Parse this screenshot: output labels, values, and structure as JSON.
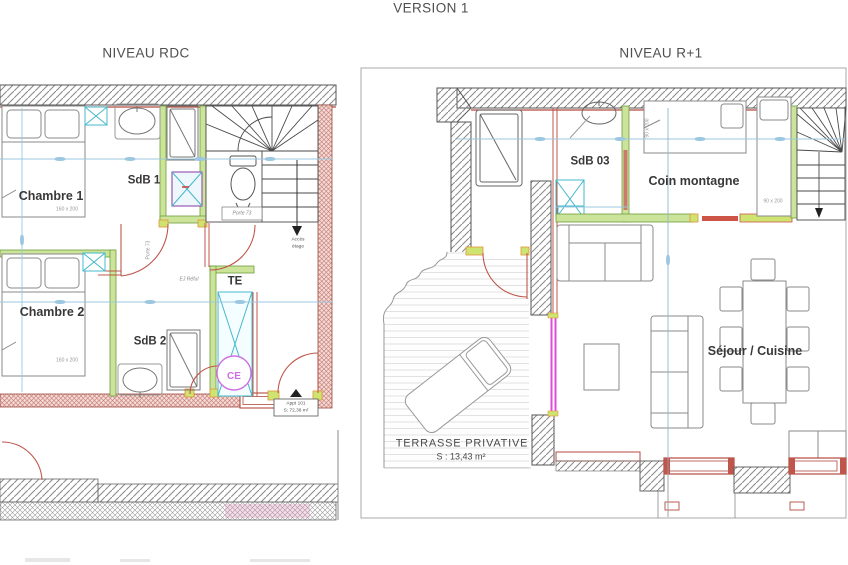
{
  "header": {
    "version_title": "VERSION 1"
  },
  "plan_rdc": {
    "title": "NIVEAU RDC",
    "labels": {
      "chambre1": "Chambre 1",
      "chambre1_bed_size": "160 x 200",
      "chambre2": "Chambre 2",
      "chambre2_bed_size": "160 x 200",
      "sdb1": "SdB 1",
      "sdb2": "SdB 2",
      "te": "TE",
      "ce": "CE",
      "porte_stairs": "Porte 73",
      "porte_chambre": "Porte 73",
      "ej_reful": "EJ Réful",
      "acces_line1": "Accès",
      "acces_line2": "étage",
      "appt_line1": "Appt 101",
      "appt_line2": "S: 72,36 m²"
    }
  },
  "plan_r1": {
    "title": "NIVEAU R+1",
    "labels": {
      "sdb03": "SdB 03",
      "coin_montagne": "Coin montagne",
      "bed_size_h": "90 x 200",
      "bed_size_v": "90 x 200",
      "sejour_cuisine": "Séjour / Cuisine",
      "terrasse_line1": "TERRASSE PRIVATIVE",
      "terrasse_line2": "S : 13,43 m²"
    }
  },
  "colors": {
    "wall_red": "#b44a3f",
    "door_red": "#c0564b",
    "partition_green_fill": "#cbe49a",
    "partition_green_edge": "#6f9c3a",
    "jamb_yellow_green": "#cfe470",
    "jamb_orange_edge": "#e0953a",
    "closet_cyan": "#45b8cc",
    "closet_purple": "#9b59b6",
    "bay_magenta": "#e24bd8",
    "ce_magenta": "#cf6ee4",
    "dim_blue": "#9cc7e0"
  }
}
